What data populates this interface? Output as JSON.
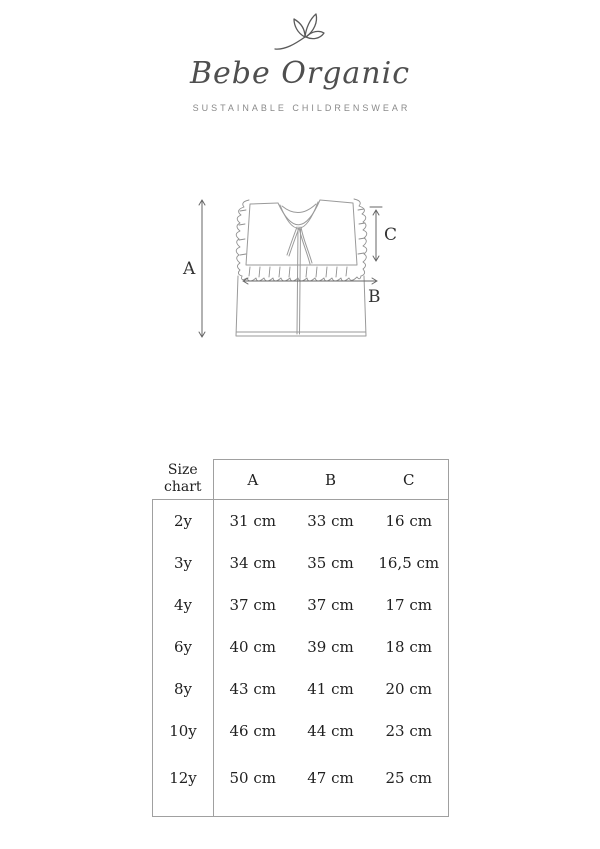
{
  "brand": {
    "name": "Bebe Organic",
    "tagline": "SUSTAINABLE CHILDRENSWEAR"
  },
  "diagram": {
    "labels": {
      "a": "A",
      "b": "B",
      "c": "C"
    }
  },
  "size_chart": {
    "corner_label": "Size chart",
    "columns": [
      "A",
      "B",
      "C"
    ],
    "rows": [
      {
        "size": "2y",
        "values": [
          "31 cm",
          "33 cm",
          "16 cm"
        ]
      },
      {
        "size": "3y",
        "values": [
          "34 cm",
          "35 cm",
          "16,5 cm"
        ]
      },
      {
        "size": "4y",
        "values": [
          "37 cm",
          "37 cm",
          "17 cm"
        ]
      },
      {
        "size": "6y",
        "values": [
          "40 cm",
          "39 cm",
          "18 cm"
        ]
      },
      {
        "size": "8y",
        "values": [
          "43 cm",
          "41 cm",
          "20 cm"
        ]
      },
      {
        "size": "10y",
        "values": [
          "46 cm",
          "44 cm",
          "23 cm"
        ]
      },
      {
        "size": "12y",
        "values": [
          "50 cm",
          "47 cm",
          "25 cm"
        ]
      }
    ]
  },
  "colors": {
    "brand_text": "#4f4f4f",
    "tagline_text": "#8a8a8a",
    "table_text": "#212121",
    "table_border": "#a0a0a0",
    "sketch_line": "#9a9a9a",
    "arrow_line": "#666666"
  }
}
